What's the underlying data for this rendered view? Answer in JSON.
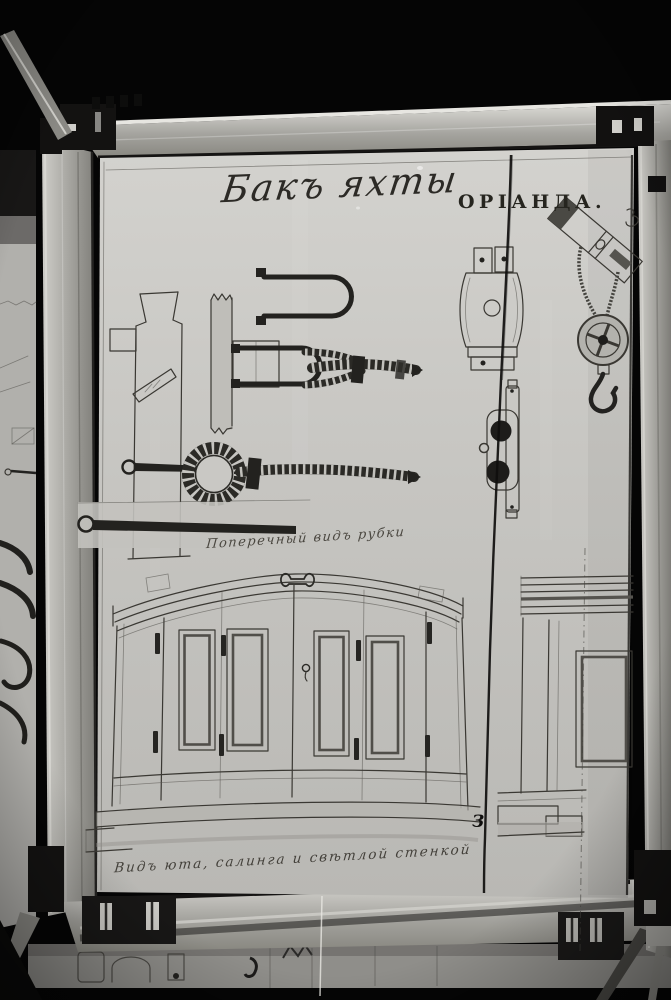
{
  "drawing": {
    "title_script": "Бакъ яхты",
    "title_caps": "ОРІАНДА.",
    "section_label": "Поперечный видъ рубки",
    "bottom_caption": "Видъ юта, салинга и свѣтлой стенкой",
    "crack_mark": "З"
  },
  "colors": {
    "background": "#050505",
    "paper": "#c7c6c2",
    "side_sheet": "#b1b0ac",
    "frame_metal": "#a9a8a3",
    "frame_highlight": "#e7e6e1",
    "clamp": "#141312",
    "ink": "#3a3833",
    "rope": "#26251f",
    "crack": "#0f0e0d"
  }
}
